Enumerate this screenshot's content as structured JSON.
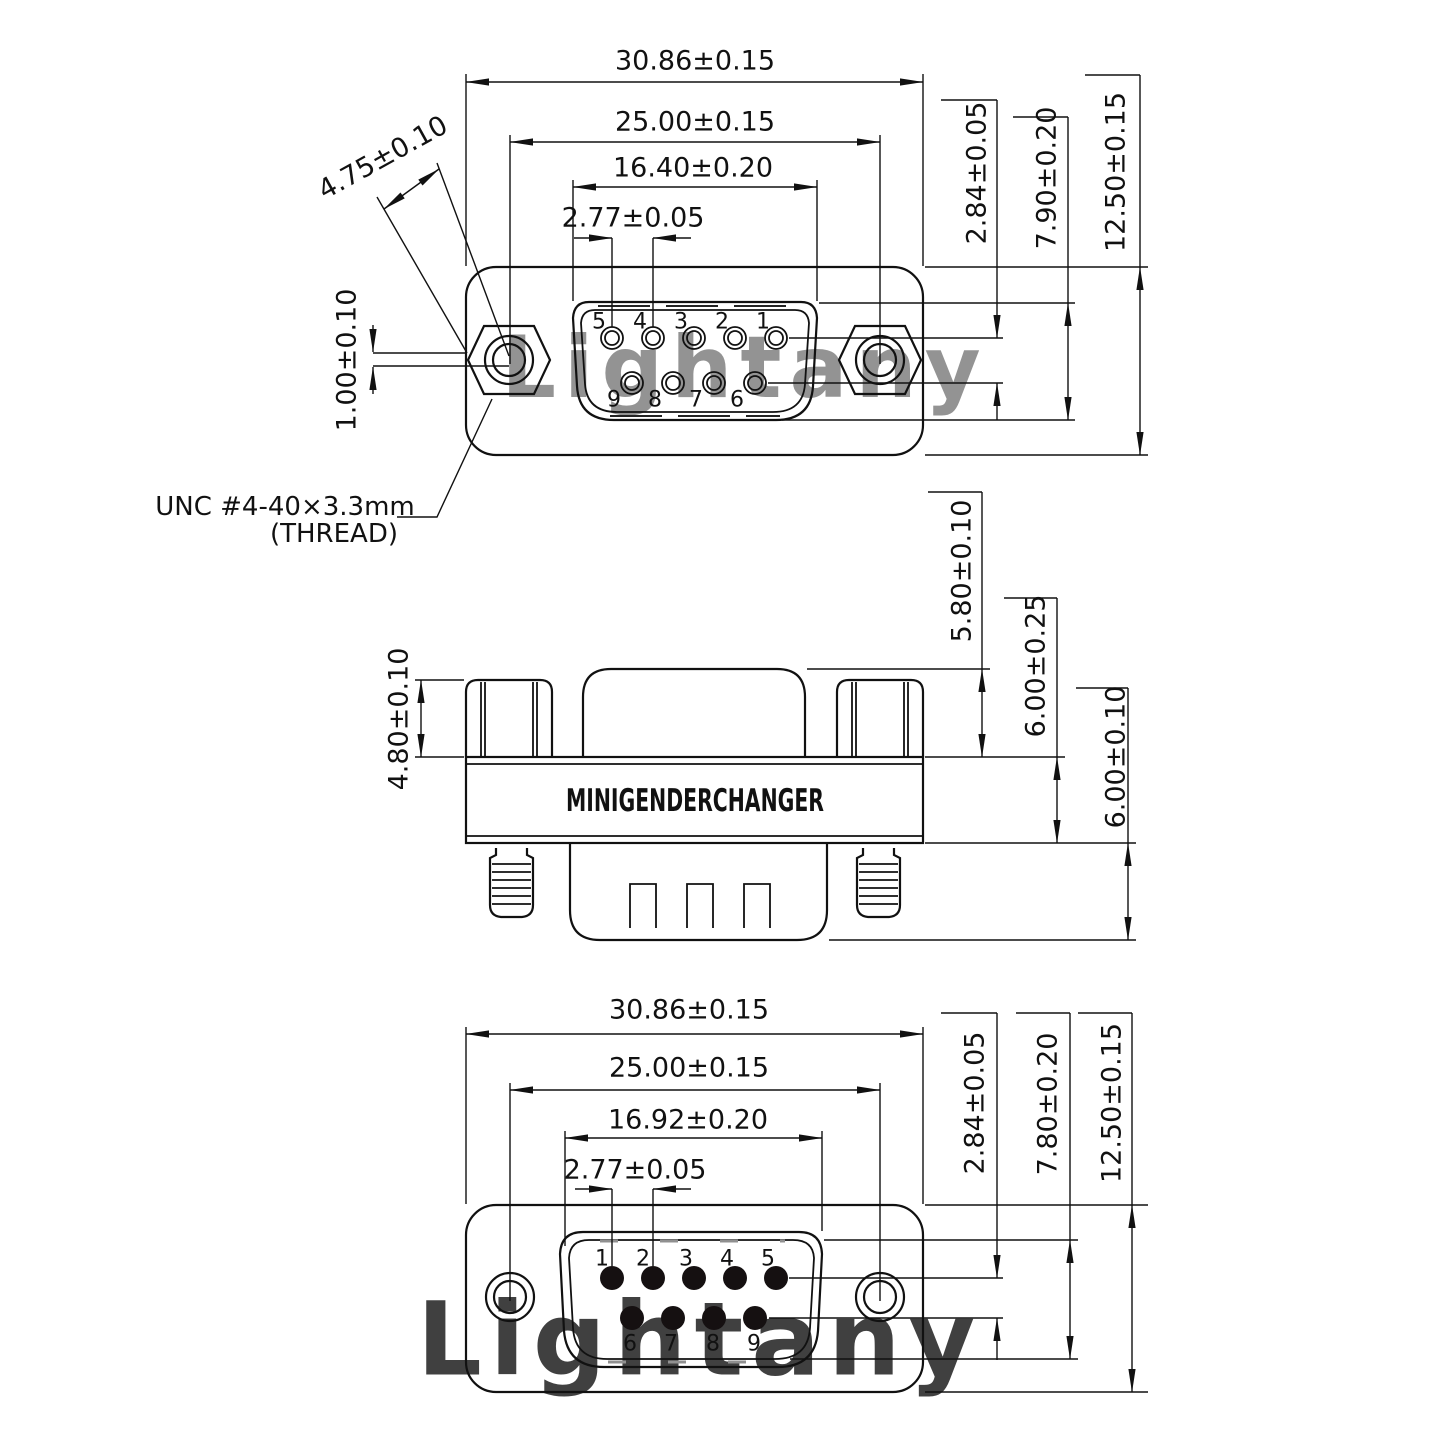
{
  "watermark": {
    "text": "Lightany",
    "color": "#eec0c0"
  },
  "colors": {
    "line": "#111111",
    "hidden_line": "#909090",
    "background": "#ffffff"
  },
  "top_view": {
    "dims": {
      "width_outer": "30.86±0.15",
      "width_holes": "25.00±0.15",
      "width_shell": "16.40±0.20",
      "pin_pitch": "2.77±0.05",
      "thread_diag": "4.75±0.10",
      "hole_offset": "1.00±0.10",
      "row_spacing": "2.84±0.05",
      "shell_height": "7.90±0.20",
      "body_height": "12.50±0.15"
    },
    "pins_top": [
      "5",
      "4",
      "3",
      "2",
      "1"
    ],
    "pins_bottom": [
      "9",
      "8",
      "7",
      "6"
    ],
    "note_line1": "UNC #4-40×3.3mm",
    "note_line2": "(THREAD)"
  },
  "side_view": {
    "label": "MINIGENDERCHANGER",
    "dims": {
      "standoff_height": "4.80±0.10",
      "hood_height": "5.80±0.10",
      "body_thickness": "6.00±0.25",
      "shell_depth": "6.00±0.10"
    }
  },
  "bottom_view": {
    "dims": {
      "width_outer": "30.86±0.15",
      "width_holes": "25.00±0.15",
      "width_shell": "16.92±0.20",
      "pin_pitch": "2.77±0.05",
      "row_spacing": "2.84±0.05",
      "shell_height": "7.80±0.20",
      "body_height": "12.50±0.15"
    },
    "pins_top": [
      "1",
      "2",
      "3",
      "4",
      "5"
    ],
    "pins_bottom": [
      "6",
      "7",
      "8",
      "9"
    ]
  }
}
